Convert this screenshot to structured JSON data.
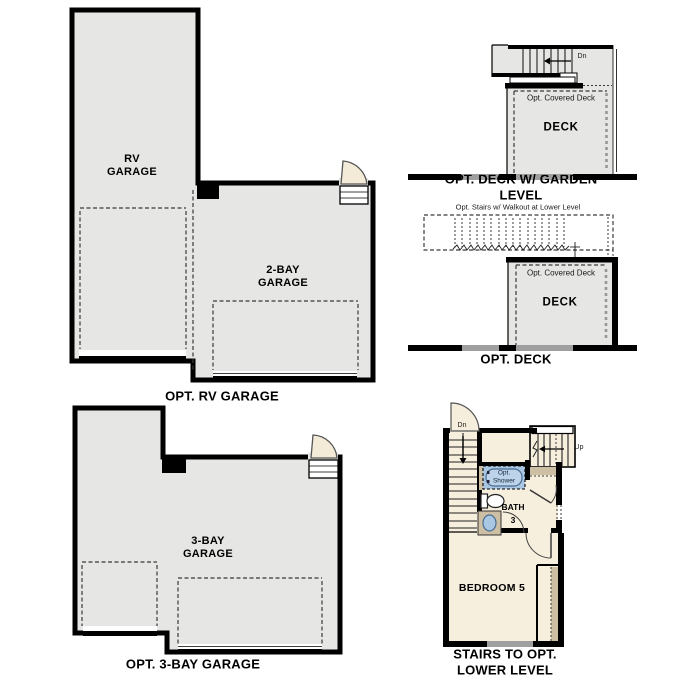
{
  "colors": {
    "background": "#ffffff",
    "wall": "#000000",
    "garage_fill": "#e6e6e4",
    "floor_fill": "#f7efde",
    "tan_fill": "#ccbfa3",
    "fixture_blue": "#a9c7e2",
    "fixture_blue_stroke": "#4a6d94",
    "door_leaf_fill": "#f3ead7"
  },
  "plans": {
    "rv_garage": {
      "caption": "OPT. RV GARAGE",
      "rv_label": "RV\nGARAGE",
      "two_bay_label": "2-BAY\nGARAGE"
    },
    "deck_garden": {
      "caption": "OPT. DECK W/ GARDEN LEVEL",
      "deck_label": "DECK",
      "covered_label": "Opt. Covered Deck",
      "down_label": "Dn"
    },
    "deck": {
      "caption": "OPT. DECK",
      "deck_label": "DECK",
      "covered_label": "Opt. Covered Deck",
      "stairs_note": "Opt. Stairs w/ Walkout at Lower Level"
    },
    "lower_level": {
      "caption": "STAIRS TO OPT.\nLOWER LEVEL",
      "bedroom_label": "BEDROOM 5",
      "bath_label": "BATH",
      "bath_number": "3",
      "shower_label": "Opt.\nShower",
      "down_label": "Dn",
      "up_label": "Up"
    },
    "three_bay": {
      "caption": "OPT. 3-BAY GARAGE",
      "room_label": "3-BAY\nGARAGE"
    }
  }
}
